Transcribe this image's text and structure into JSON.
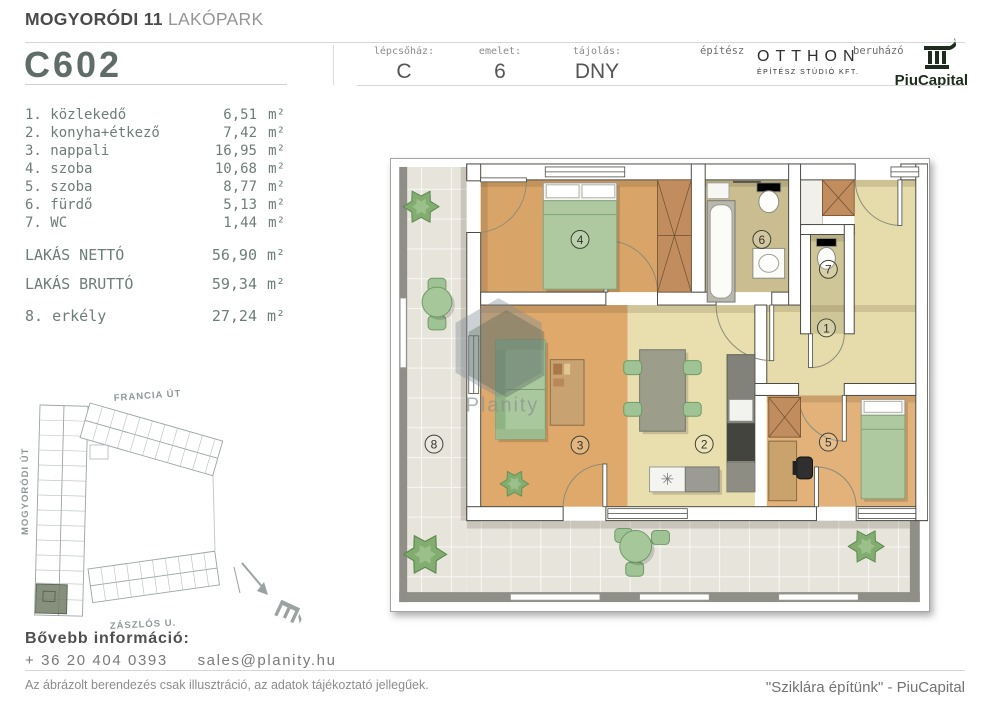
{
  "header": {
    "title_bold": "MOGYORÓDI 11",
    "title_light": "LAKÓPARK",
    "unit_code": "C602",
    "fields": [
      {
        "label": "lépcsőház:",
        "value": "C"
      },
      {
        "label": "emelet:",
        "value": "6"
      },
      {
        "label": "tájolás:",
        "value": "DNY"
      }
    ],
    "architect": {
      "label": "építész",
      "name": "OTTHON",
      "subtitle": "ÉPÍTÉSZ STÚDIÓ KFT."
    },
    "developer": {
      "label": "beruházó",
      "name": "PiuCapital"
    }
  },
  "room_list": {
    "rooms": [
      {
        "name": "1. közlekedő",
        "value": "6,51",
        "unit": "m²"
      },
      {
        "name": "2. konyha+étkező",
        "value": "7,42",
        "unit": "m²"
      },
      {
        "name": "3. nappali",
        "value": "16,95",
        "unit": "m²"
      },
      {
        "name": "4. szoba",
        "value": "10,68",
        "unit": "m²"
      },
      {
        "name": "5. szoba",
        "value": "8,77",
        "unit": "m²"
      },
      {
        "name": "6. fürdő",
        "value": "5,13",
        "unit": "m²"
      },
      {
        "name": "7. WC",
        "value": "1,44",
        "unit": "m²"
      }
    ],
    "summary": [
      {
        "name": "LAKÁS NETTÓ",
        "value": "56,90",
        "unit": "m²"
      },
      {
        "name": "LAKÁS BRUTTÓ",
        "value": "59,34",
        "unit": "m²"
      }
    ],
    "balcony": {
      "name": "8. erkély",
      "value": "27,24",
      "unit": "m²"
    }
  },
  "floor_plan": {
    "watermark": "Planity",
    "room_labels": [
      "1",
      "2",
      "3",
      "4",
      "5",
      "6",
      "7",
      "8"
    ]
  },
  "site_plan": {
    "street_top": "FRANCIA ÚT",
    "street_left": "MOGYORÓDI ÚT",
    "street_bottom": "ZÁSZLÓS U.",
    "compass": "É"
  },
  "contact": {
    "heading": "Bővebb információ:",
    "phone": "+ 36 20 404 0393",
    "email": "sales@planity.hu"
  },
  "footer": {
    "disclaimer": "Az ábrázolt berendezés csak illusztráció, az adatok tájékoztató jellegűek.",
    "slogan": "\"Sziklára építünk\" - PiuCapital"
  },
  "colors": {
    "highlight_unit": "#727c66",
    "logo_dark": "#1e2c1e",
    "bed_green": "#aec9a0",
    "wood_floor": "#d9a468"
  }
}
